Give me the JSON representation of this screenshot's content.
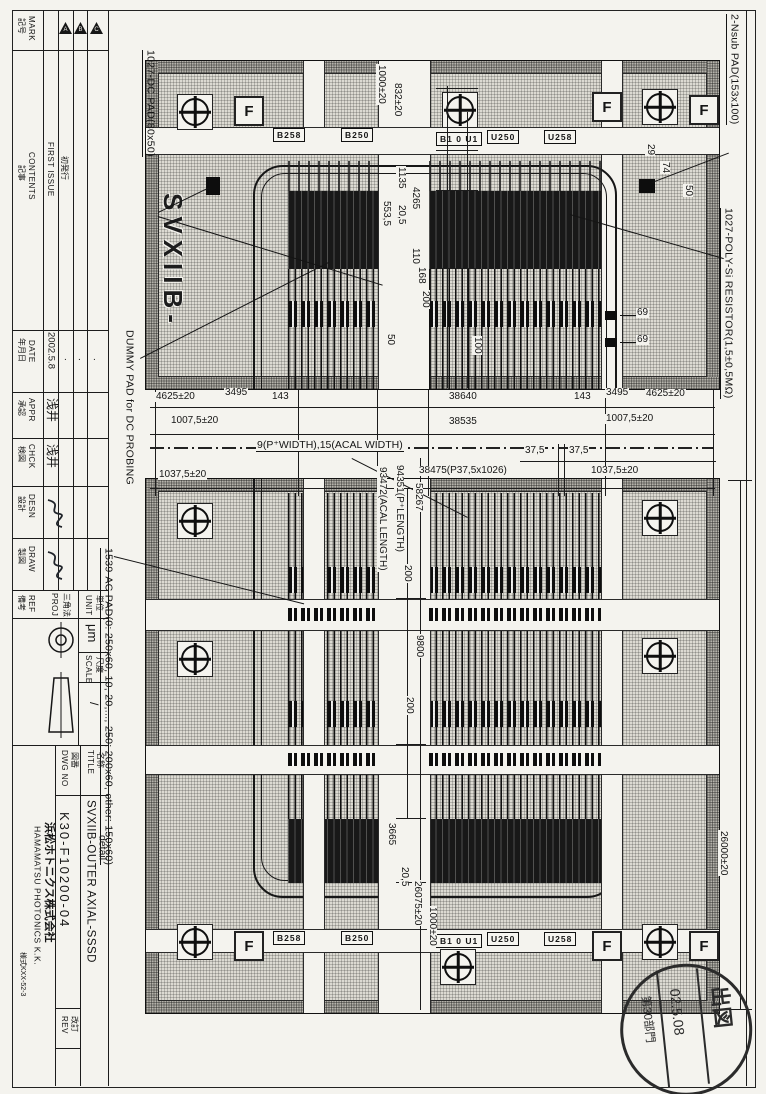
{
  "tb": {
    "mark_en": "MARK",
    "mark_jp": "記号",
    "rev_marks": [
      "A",
      "B",
      "C"
    ],
    "contents_en": "CONTENTS",
    "contents_jp": "記事",
    "first_issue_en": "FIRST ISSUE",
    "first_issue_jp": "初発行",
    "date_en": "DATE",
    "date_jp": "年月日",
    "date_value": "2002.5.8",
    "dot": ".",
    "appr_en": "APPR",
    "appr_jp": "承認",
    "appr_sign": "浅井",
    "chck_en": "CHCK",
    "chck_jp": "検図",
    "chck_sign": "浅井",
    "desn_en": "DESN",
    "desn_jp": "設計",
    "draw_en": "DRAW",
    "draw_jp": "製図",
    "ref_en": "REF",
    "ref_jp": "備考",
    "proj_en": "PROJ",
    "proj_jp": "三角法",
    "unit_en": "UNIT",
    "unit_jp": "単位",
    "unit_value": "μm",
    "scale_en": "SCALE",
    "scale_jp": "尺度",
    "scale_value": "/",
    "title_en": "TITLE",
    "title_jp": "名称",
    "title_value": "SVXIIB-OUTER AXIAL-SSSD",
    "title_value2": "detail",
    "dwg_en": "DWG NO",
    "dwg_jp": "図番",
    "dwg_value": "K30-F10200-04",
    "rev_en": "REV",
    "rev_jp": "改訂",
    "company_en": "HAMAMATSU PHOTONICS K.K.",
    "company_jp": "浜松ホトニクス株式会社",
    "form_no": "様式KXX-52-3"
  },
  "ann": {
    "dc_pad": "1027-DC PAD(80x50)",
    "nsub_pad": "2-Nsub PAD(153x100)",
    "poly_res": "1027-POLY-Si RESISTOR(1,5±0,5MΩ)",
    "dummy_pad": "DUMMY PAD for DC PROBING",
    "ac_pad": "1539-AC PAD(0: 250x60, 10, 20,..., 250: 200x60, other: 150x60)",
    "die_label": "SVXIIB-",
    "strip_callout": "9(P⁺WIDTH),15(ACAL WIDTH)"
  },
  "dim": {
    "t1000": "1000±20",
    "t832": "832±20",
    "t1135": "1135",
    "t205": "20,5",
    "t4265": "4265",
    "t5535": "553,5",
    "t110": "110",
    "t168": "168",
    "t200": "200",
    "t100": "100",
    "t50": "50",
    "c29": "29",
    "c74": "74",
    "c50": "50",
    "r69a": "69",
    "r69b": "69",
    "m4625L": "4625±20",
    "m3495L": "3495",
    "m143L": "143",
    "m38640": "38640",
    "m143R": "143",
    "m3495R": "3495",
    "m4625R": "4625±20",
    "m10075L": "1007,5±20",
    "m38535": "38535",
    "m10075R": "1007,5±20",
    "m375a": "37,5",
    "m375b": "37,5",
    "m38475": "38475(P37,5x1026)",
    "m10375L": "1037,5±20",
    "m10375R": "1037,5±20",
    "v94351": "94351(P⁺LENGTH)",
    "v93472": "93472(ACAL LENGTH)",
    "v58267": "58267",
    "v200a": "200",
    "v9800": "9800",
    "v200b": "200",
    "b3665": "3665",
    "b205": "20,5",
    "b26075": "26075±20",
    "b1000": "1000±20",
    "r26000": "26000±20"
  },
  "labels": {
    "tl1": "B258",
    "tl2": "B250",
    "tc": "B1 0 U1",
    "tr1": "U250",
    "tr2": "U258",
    "bl1": "B258",
    "bl2": "B250",
    "bc": "B1 0 U1",
    "br1": "U250",
    "br2": "U258"
  },
  "fid": {
    "f": "F"
  },
  "stamp": {
    "right": "出図",
    "date": "02.5.08",
    "left": "第30部門"
  }
}
